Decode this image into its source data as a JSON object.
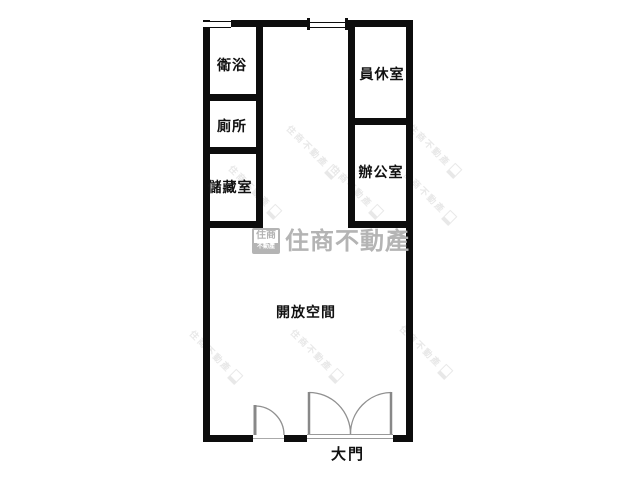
{
  "floorplan": {
    "rooms": [
      {
        "label": "衛浴"
      },
      {
        "label": "廁所"
      },
      {
        "label": "儲藏室"
      },
      {
        "label": "員休室"
      },
      {
        "label": "辦公室"
      },
      {
        "label": "開放空間"
      }
    ],
    "entrance_label": "大門",
    "features": {
      "doors": [
        "single-door",
        "double-door-main-entrance"
      ],
      "windows": [
        "top-left-window",
        "top-center-opening"
      ]
    }
  },
  "watermark": {
    "logo_top": "住商",
    "logo_bottom": "不動產",
    "brand_text": "住商不動產",
    "color": "#b4b4b4"
  },
  "mini_watermark_text": "住商不動產"
}
